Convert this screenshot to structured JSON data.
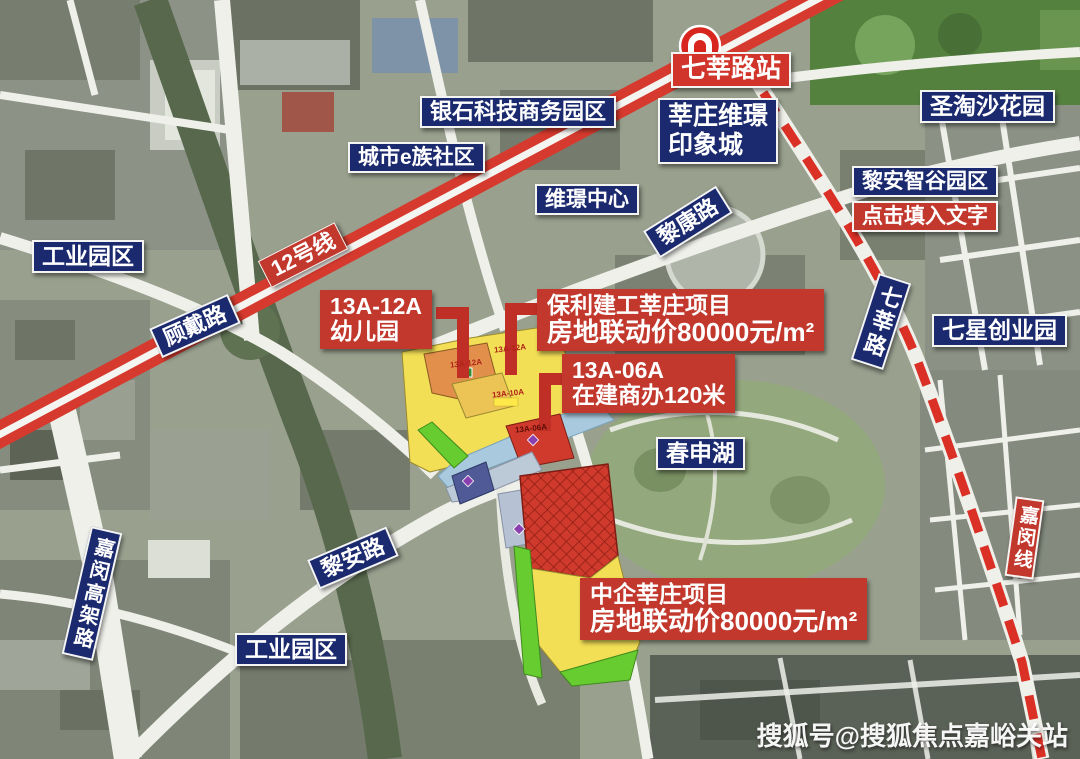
{
  "watermark": "搜狐号@搜狐焦点嘉峪关站",
  "area_labels": {
    "yinshi_park": "银石科技商务园区",
    "city_e_community": "城市e族社区",
    "weijing_mall_l1": "莘庄维璟",
    "weijing_mall_l2": "印象城",
    "sentosa_garden": "圣淘沙花园",
    "lian_smart_valley": "黎安智谷园区",
    "click_placeholder": "点击填入文字",
    "weijing_center": "维璟中心",
    "industrial_park_top": "工业园区",
    "industrial_park_bottom": "工业园区",
    "qixing_park": "七星创业园",
    "chunshen_lake": "春申湖"
  },
  "road_labels": {
    "likang_road": "黎康路",
    "gudai_road": "顾戴路",
    "qixin_road": "七莘路",
    "lian_road": "黎安路",
    "jiamin_viaduct": "嘉闵高架路",
    "metro_line12": "12号线",
    "jiamin_line": "嘉闵线",
    "qixin_station": "七莘路站"
  },
  "callouts": {
    "kindergarten": {
      "line1": "13A-12A",
      "line2": "幼儿园"
    },
    "baoli_project": {
      "line1": "保利建工莘庄项目",
      "line2": "房地联动价80000元/m²"
    },
    "office_tower": {
      "line1": "13A-06A",
      "line2": "在建商办120米"
    },
    "zhongqi_project": {
      "line1": "中企莘庄项目",
      "line2": "房地联动价80000元/m²"
    }
  },
  "plot_labels": {
    "p1": "13A-12A",
    "p2": "13A-12A",
    "p3": "13A-10A",
    "p4": "13A-06A"
  },
  "colors": {
    "navy_badge": "#1b2a6e",
    "red_badge": "#c2382d",
    "metro_band_red": "#d63a2e",
    "plan_yellow": "#f2df55",
    "plan_orange": "#e28f4c",
    "plan_red": "#cf3a2c",
    "plan_green": "#67cc30",
    "plan_canal_blue": "#a9cade"
  }
}
